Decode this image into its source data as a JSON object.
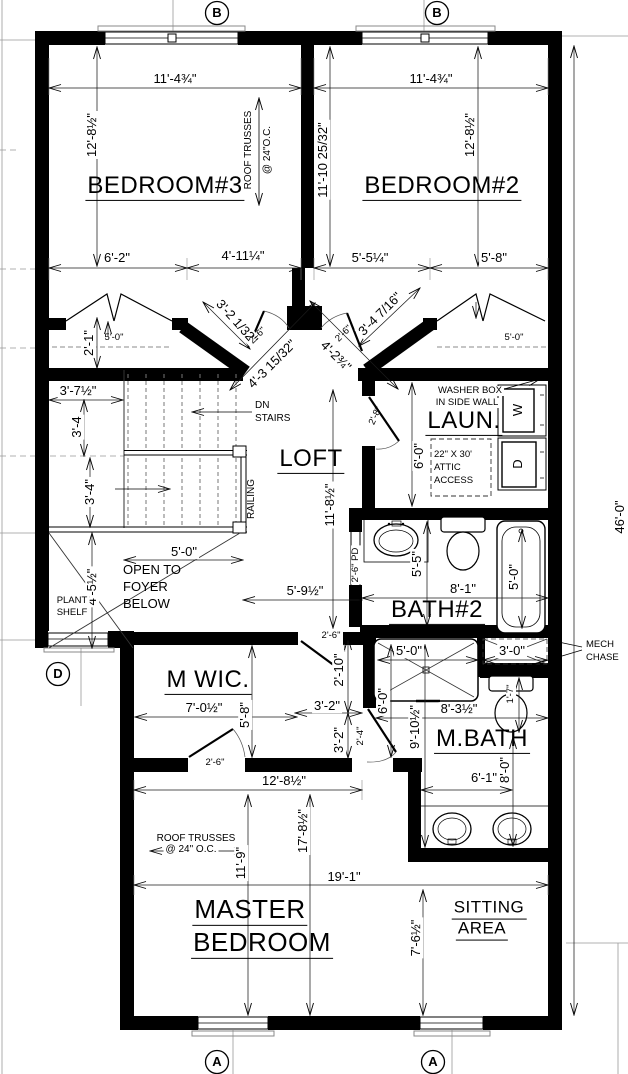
{
  "bubbles": {
    "top_left": "B",
    "top_right": "B",
    "bottom_left": "A",
    "bottom_right": "A",
    "left": "D"
  },
  "rooms": {
    "bedroom3": "BEDROOM#3",
    "bedroom2": "BEDROOM#2",
    "loft": "LOFT",
    "laundry": "LAUN.",
    "bath2": "BATH#2",
    "mwic": "M WIC.",
    "mbath": "M.BATH",
    "master_line1": "MASTER",
    "master_line2": "BEDROOM",
    "sitting_line1": "SITTING",
    "sitting_line2": "AREA"
  },
  "dims": {
    "b3_width": "11'-4¾\"",
    "b3_height": "12'-8½\"",
    "b2_width": "11'-4¾\"",
    "b2_height": "12'-8½\"",
    "b2_depth": "11'-10 25/32\"",
    "b3_closet_left": "6'-2\"",
    "b3_closet_right": "4'-11¼\"",
    "b2_closet_left": "5'-5¼\"",
    "b2_closet_right": "5'-8\"",
    "closet3_width": "5'-0\"",
    "closet2_width": "5'-0\"",
    "closet_depth": "2'-1\"",
    "diag_left": "3'-2 1/32\"",
    "diag_left_long": "4'-3 15/32\"",
    "diag_right_long": "4'-2¾\"",
    "diag_right": "3'-4 7/16\"",
    "door_b3": "2'-6\"",
    "door_b2": "2'-6\"",
    "hall_3_7": "3'-7½\"",
    "hall_3_4a": "3'-4",
    "hall_3_4b": "3'-4\"",
    "foyer_4_5": "4'-5½\"",
    "foyer_width": "5'-0\"",
    "loft_width": "5'-9½\"",
    "loft_depth": "11'-8½\"",
    "laundry_depth": "6'-0\"",
    "door_laundry": "2'-8\"",
    "pocket_door": "2'-6\" PD",
    "bath2_depth": "5'-5\"",
    "bath2_width": "8'-1\"",
    "tub_length": "5'-0\"",
    "shower_width": "5'-0\"",
    "chase_width": "3'-0\"",
    "vest_2_10": "2'-10\"",
    "vest_3_2w": "3'-2\"",
    "vest_3_2h": "3'-2\"",
    "door_vest": "2'-4\"",
    "shower_depth": "6'-0\"",
    "mbath_depth": "9'-10½\"",
    "mbath_width": "8'-3½\"",
    "toilet_1_7": "1'-7\"",
    "mbath_8_0": "8'-0\"",
    "vanity_6_1": "6'-1\"",
    "wic_width": "7'-0½\"",
    "wic_depth": "5'-8\"",
    "door_wic": "2'-6\"",
    "door_hall": "2'-6\"",
    "master_12_8": "12'-8½\"",
    "master_17_8": "17'-8½\"",
    "master_11_9": "11'-9\"",
    "master_19_1": "19'-1\"",
    "sitting_7_6": "7'-6½\"",
    "overall_height": "46'-0\""
  },
  "notes": {
    "roof_trusses_b3_1": "ROOF TRUSSES",
    "roof_trusses_b3_2": "@ 24\"O.C.",
    "roof_trusses_m_1": "ROOF TRUSSES",
    "roof_trusses_m_2": "@ 24\" O.C.",
    "dn_1": "DN",
    "dn_2": "STAIRS",
    "railing": "RAILING",
    "washer_box_1": "WASHER BOX",
    "washer_box_2": "IN SIDE WALL",
    "attic_1": "22\" X 30'",
    "attic_2": "ATTIC",
    "attic_3": "ACCESS",
    "washer": "W",
    "dryer": "D",
    "open_1": "OPEN TO",
    "open_2": "FOYER",
    "open_3": "BELOW",
    "plant_1": "PLANT",
    "plant_2": "SHELF",
    "mech_1": "MECH",
    "mech_2": "CHASE"
  }
}
